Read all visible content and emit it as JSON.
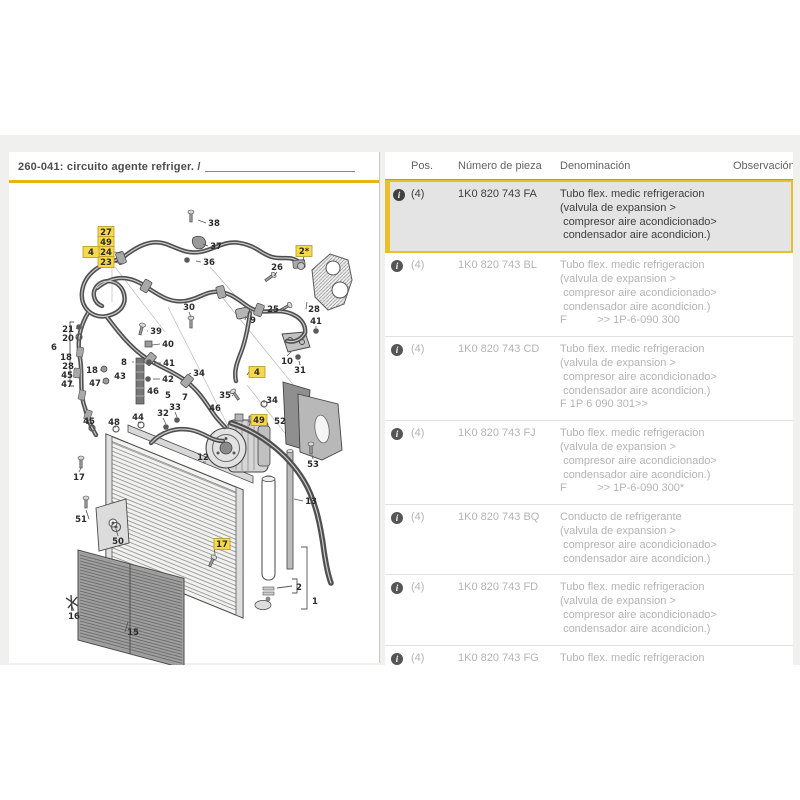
{
  "diagram": {
    "title": "260-041: circuito agente refriger. /",
    "labels": [
      {
        "t": "38",
        "x": 214,
        "y": 221,
        "lx": 198,
        "ly": 218
      },
      {
        "t": "37",
        "x": 216,
        "y": 244,
        "lx": 203,
        "ly": 242
      },
      {
        "t": "36",
        "x": 209,
        "y": 260,
        "lx": 196,
        "ly": 259
      },
      {
        "t": "26",
        "x": 277,
        "y": 265,
        "lx": 274,
        "ly": 274
      },
      {
        "t": "25",
        "x": 273,
        "y": 307,
        "lx": 284,
        "ly": 307
      },
      {
        "t": "28",
        "x": 314,
        "y": 307,
        "lx": 307,
        "ly": 300
      },
      {
        "t": "41",
        "x": 316,
        "y": 319,
        "lx": 316,
        "ly": 326
      },
      {
        "t": "9",
        "x": 253,
        "y": 318,
        "lx": 246,
        "ly": 314
      },
      {
        "t": "30",
        "x": 189,
        "y": 305,
        "lx": 191,
        "ly": 315
      },
      {
        "t": "39",
        "x": 156,
        "y": 329,
        "lx": 147,
        "ly": 329
      },
      {
        "t": "40",
        "x": 168,
        "y": 342,
        "lx": 152,
        "ly": 343
      },
      {
        "t": "8",
        "x": 124,
        "y": 360,
        "lx": 134,
        "ly": 360
      },
      {
        "t": "41",
        "x": 169,
        "y": 361,
        "lx": 154,
        "ly": 361
      },
      {
        "t": "43",
        "x": 120,
        "y": 374
      },
      {
        "t": "42",
        "x": 168,
        "y": 377,
        "lx": 153,
        "ly": 377
      },
      {
        "t": "18",
        "x": 92,
        "y": 368,
        "lx": 101,
        "ly": 368
      },
      {
        "t": "47",
        "x": 95,
        "y": 381,
        "lx": 103,
        "ly": 380
      },
      {
        "t": "46",
        "x": 153,
        "y": 389
      },
      {
        "t": "5",
        "x": 168,
        "y": 393
      },
      {
        "t": "34",
        "x": 199,
        "y": 371,
        "lx": 189,
        "ly": 372
      },
      {
        "t": "33",
        "x": 175,
        "y": 405,
        "lx": 177,
        "ly": 415
      },
      {
        "t": "32",
        "x": 163,
        "y": 411,
        "lx": 166,
        "ly": 422
      },
      {
        "t": "44",
        "x": 138,
        "y": 415,
        "lx": 141,
        "ly": 421
      },
      {
        "t": "48",
        "x": 114,
        "y": 420,
        "lx": 116,
        "ly": 425
      },
      {
        "t": "45",
        "x": 89,
        "y": 419,
        "lx": 92,
        "ly": 424
      },
      {
        "t": "35",
        "x": 225,
        "y": 393,
        "lx": 232,
        "ly": 394
      },
      {
        "t": "46",
        "x": 215,
        "y": 406
      },
      {
        "t": "7",
        "x": 185,
        "y": 395
      },
      {
        "t": "34",
        "x": 272,
        "y": 398,
        "lx": 264,
        "ly": 401
      },
      {
        "t": "21",
        "x": 68,
        "y": 327,
        "lx": 77,
        "ly": 326
      },
      {
        "t": "20",
        "x": 68,
        "y": 336,
        "lx": 77,
        "ly": 335
      },
      {
        "t": "6",
        "x": 54,
        "y": 345
      },
      {
        "t": "18",
        "x": 66,
        "y": 355
      },
      {
        "t": "28",
        "x": 68,
        "y": 364
      },
      {
        "t": "45",
        "x": 67,
        "y": 373
      },
      {
        "t": "47",
        "x": 67,
        "y": 382
      },
      {
        "t": "10",
        "x": 287,
        "y": 359,
        "lx": 291,
        "ly": 350
      },
      {
        "t": "31",
        "x": 300,
        "y": 368,
        "lx": 299,
        "ly": 359
      },
      {
        "t": "52",
        "x": 280,
        "y": 419
      },
      {
        "t": "53",
        "x": 313,
        "y": 462,
        "lx": 312,
        "ly": 453
      },
      {
        "t": "17",
        "x": 79,
        "y": 475,
        "lx": 81,
        "ly": 466
      },
      {
        "t": "51",
        "x": 81,
        "y": 517,
        "lx": 86,
        "ly": 508
      },
      {
        "t": "50",
        "x": 118,
        "y": 539,
        "lx": 116,
        "ly": 527
      },
      {
        "t": "12",
        "x": 203,
        "y": 455,
        "lx": 206,
        "ly": 460
      },
      {
        "t": "13",
        "x": 311,
        "y": 499,
        "lx": 294,
        "ly": 497
      },
      {
        "t": "16",
        "x": 74,
        "y": 614,
        "lx": 72,
        "ly": 604
      },
      {
        "t": "2",
        "x": 299,
        "y": 585
      },
      {
        "t": "1",
        "x": 315,
        "y": 599
      },
      {
        "t": "15",
        "x": 133,
        "y": 630,
        "lx": 128,
        "ly": 620
      },
      {
        "t": "27",
        "x": 106,
        "y": 230,
        "hl": true
      },
      {
        "t": "49",
        "x": 106,
        "y": 240,
        "hl": true
      },
      {
        "t": "24",
        "x": 106,
        "y": 250,
        "hl": true,
        "lx": 121,
        "ly": 251
      },
      {
        "t": "23",
        "x": 106,
        "y": 260,
        "hl": true,
        "lx": 123,
        "ly": 262
      },
      {
        "t": "4",
        "x": 91,
        "y": 250,
        "hl": true
      },
      {
        "t": "2*",
        "x": 304,
        "y": 249,
        "hl": true,
        "lx": 303,
        "ly": 259
      },
      {
        "t": "4",
        "x": 257,
        "y": 370,
        "hl": true,
        "lx": 247,
        "ly": 373
      },
      {
        "t": "49",
        "x": 259,
        "y": 418,
        "hl": true,
        "lx": 249,
        "ly": 424
      },
      {
        "t": "17",
        "x": 222,
        "y": 542,
        "hl": true,
        "lx": 215,
        "ly": 553
      }
    ]
  },
  "table": {
    "headers": [
      "Pos.",
      "Número de pieza",
      "Denominación",
      "Observación"
    ],
    "rows": [
      {
        "pos": "(4)",
        "part": "1K0 820 743 FA",
        "obs": "",
        "state": "highlighted",
        "desc": [
          "Tubo flex. medic refrigeracion",
          "(valvula de expansion >",
          " compresor aire acondicionado>",
          " condensador aire acondicion.)"
        ]
      },
      {
        "pos": "(4)",
        "part": "1K0 820 743 BL",
        "obs": "",
        "state": "muted",
        "desc": [
          "Tubo flex. medic refrigeracion",
          "(valvula de expansion >",
          " compresor aire acondicionado>",
          " condensador aire acondicion.)",
          "F          >> 1P-6-090 300"
        ]
      },
      {
        "pos": "(4)",
        "part": "1K0 820 743 CD",
        "obs": "",
        "state": "muted",
        "desc": [
          "Tubo flex. medic refrigeracion",
          "(valvula de expansion >",
          " compresor aire acondicionado>",
          " condensador aire acondicion.)",
          "F 1P 6 090 301>>"
        ]
      },
      {
        "pos": "(4)",
        "part": "1K0 820 743 FJ",
        "obs": "",
        "state": "muted",
        "desc": [
          "Tubo flex. medic refrigeracion",
          "(valvula de expansion >",
          " compresor aire acondicionado>",
          " condensador aire acondicion.)",
          "F          >> 1P-6-090 300*"
        ]
      },
      {
        "pos": "(4)",
        "part": "1K0 820 743 BQ",
        "obs": "",
        "state": "muted",
        "desc": [
          "Conducto de refrigerante",
          "(valvula de expansion >",
          " compresor aire acondicionado>",
          " condensador aire acondicion.)"
        ]
      },
      {
        "pos": "(4)",
        "part": "1K0 820 743 FD",
        "obs": "",
        "state": "muted",
        "desc": [
          "Tubo flex. medic refrigeracion",
          "(valvula de expansion >",
          " compresor aire acondicionado>",
          " condensador aire acondicion.)"
        ]
      },
      {
        "pos": "(4)",
        "part": "1K0 820 743 FG",
        "obs": "",
        "state": "muted",
        "desc": [
          "Tubo flex. medic refrigeracion"
        ]
      }
    ]
  },
  "colors": {
    "accent_yellow": "#e9b413",
    "highlight_border": "#e9c02b",
    "highlight_bg": "#e4e4e4",
    "label_yellow": "#f7d84b"
  }
}
